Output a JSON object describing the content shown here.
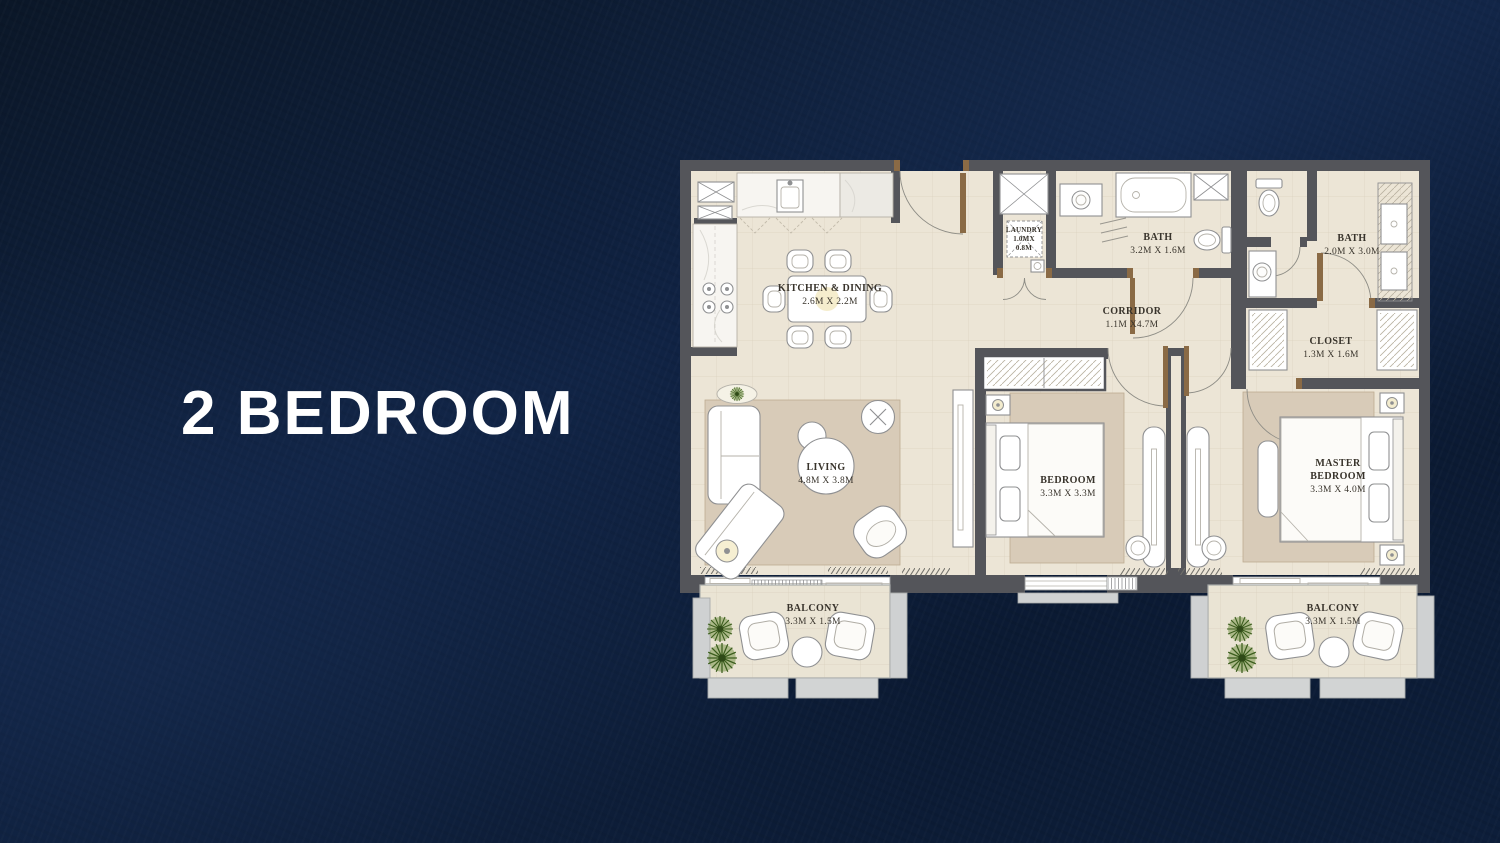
{
  "title": "2 BEDROOM",
  "rooms": {
    "kitchen_dining": {
      "name": "KITCHEN & DINING",
      "dims": "2.6M X 2.2M"
    },
    "laundry": {
      "name": "LAUNDRY",
      "dims_line1": "1.0MX",
      "dims_line2": "0.8M"
    },
    "bath_1": {
      "name": "BATH",
      "dims": "3.2M X 1.6M"
    },
    "bath_2": {
      "name": "BATH",
      "dims": "2.0M X 3.0M"
    },
    "corridor": {
      "name": "CORRIDOR",
      "dims": "1.1M X4.7M"
    },
    "closet": {
      "name": "CLOSET",
      "dims": "1.3M X 1.6M"
    },
    "living": {
      "name": "LIVING",
      "dims": "4.8M X 3.8M"
    },
    "bedroom": {
      "name": "BEDROOM",
      "dims": "3.3M X 3.3M"
    },
    "master_bedroom": {
      "name_line1": "MASTER",
      "name_line2": "BEDROOM",
      "dims": "3.3M X 4.0M"
    },
    "balcony_left": {
      "name": "BALCONY",
      "dims": "3.3M X 1.5M"
    },
    "balcony_right": {
      "name": "BALCONY",
      "dims": "3.3M X 1.5M"
    }
  },
  "colors": {
    "background_navy": "#0e2040",
    "title_text": "#ffffff",
    "wall": "#54555a",
    "floor": "#ece5d6",
    "rug": "#d8cbb8",
    "balcony_structure": "#cfd1d2",
    "door_wood": "#8a6a45",
    "plant_green": "#4e712b",
    "label_text": "#38332b"
  }
}
